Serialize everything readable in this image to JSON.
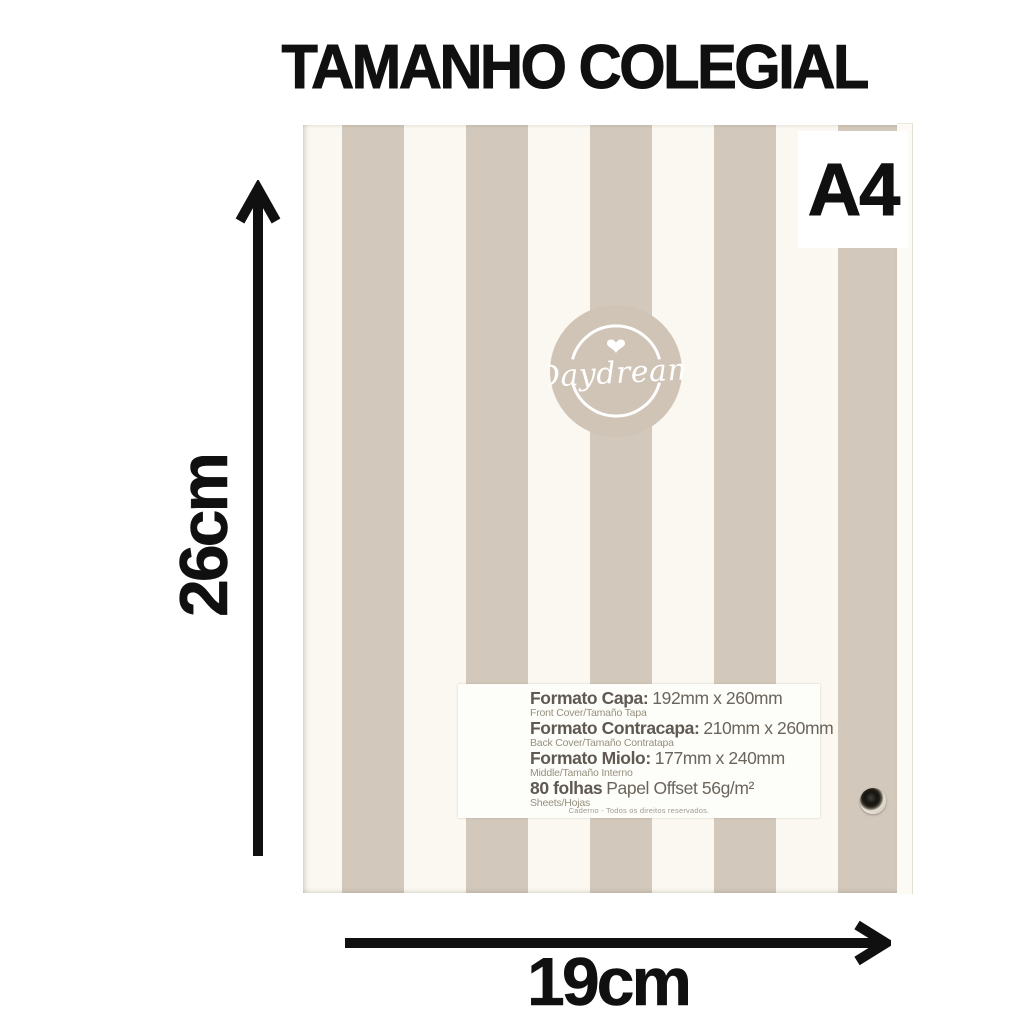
{
  "page": {
    "title": "TAMANHO COLEGIAL"
  },
  "badge": {
    "label": "A4"
  },
  "measurements": {
    "height": "26cm",
    "width": "19cm"
  },
  "logo": {
    "brand": "Daydream",
    "heart_icon": "heart"
  },
  "spec": {
    "rows": [
      {
        "name": "Formato Capa:",
        "value": "192mm x 260mm",
        "sub": "Front Cover/Tamaño Tapa"
      },
      {
        "name": "Formato Contracapa:",
        "value": "210mm x 260mm",
        "sub": "Back Cover/Tamaño Contratapa"
      },
      {
        "name": "Formato Miolo:",
        "value": "177mm x 240mm",
        "sub": "Middle/Tamaño Interno"
      },
      {
        "name": "80 folhas",
        "value": "Papel Offset 56g/m²",
        "sub": "Sheets/Hojas"
      }
    ],
    "footnote": "Caderno - Todos os direitos reservados."
  },
  "colors": {
    "stripe": "#d2c8bb",
    "cover": "#faf8f1",
    "logo_circle": "#cfc4b6",
    "ink": "#101010",
    "label_text": "#6b655c",
    "label_subtext": "#97907f",
    "page_bg": "#ffffff"
  }
}
